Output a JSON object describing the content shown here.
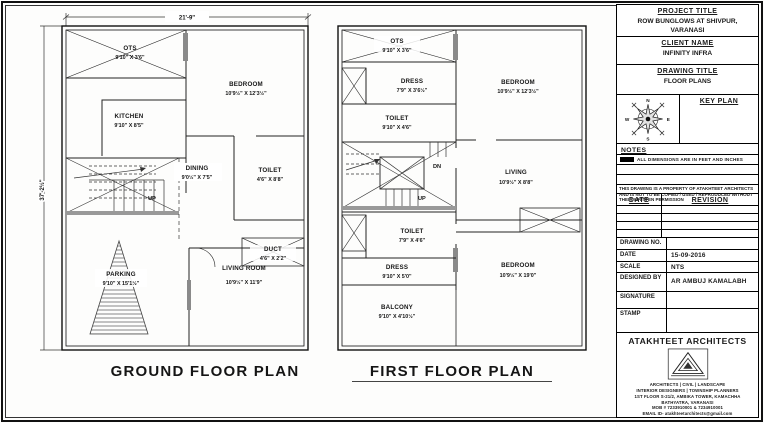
{
  "ground_floor": {
    "title": "GROUND FLOOR PLAN",
    "dim_width": "21'-9\"",
    "dim_height": "37'-2½\"",
    "stair_up": "UP",
    "rooms": {
      "ots": {
        "name": "OTS",
        "size": "9'10\" X 3'6\""
      },
      "kitchen": {
        "name": "KITCHEN",
        "size": "9'10\" X 8'5\""
      },
      "bedroom": {
        "name": "BEDROOM",
        "size": "10'9½\" X 12'3½\""
      },
      "dining": {
        "name": "DINING",
        "size": "9'0½\" X 7'5\""
      },
      "toilet": {
        "name": "TOILET",
        "size": "4'6\" X 8'8\""
      },
      "duct": {
        "name": "DUCT",
        "size": "4'6\" X 2'2\""
      },
      "parking": {
        "name": "PARKING",
        "size": "9'10\" X 15'1½\""
      },
      "living": {
        "name": "LIVING ROOM",
        "size": "10'9½\" X 11'9\""
      }
    }
  },
  "first_floor": {
    "title": "FIRST FLOOR PLAN",
    "stair_up": "UP",
    "stair_dn": "DN",
    "rooms": {
      "ots": {
        "name": "OTS",
        "size": "9'10\" X 3'6\""
      },
      "dress1": {
        "name": "DRESS",
        "size": "7'9\" X 3'6½\""
      },
      "bedroom1": {
        "name": "BEDROOM",
        "size": "10'9½\" X 12'3½\""
      },
      "toilet1": {
        "name": "TOILET",
        "size": "9'10\" X 4'6\""
      },
      "living": {
        "name": "LIVING",
        "size": "10'9½\" X 8'8\""
      },
      "toilet2": {
        "name": "TOILET",
        "size": "7'9\" X 4'6\""
      },
      "dress2": {
        "name": "DRESS",
        "size": "9'10\" X 5'0\""
      },
      "bedroom2": {
        "name": "BEDROOM",
        "size": "10'9½\" X 19'0\""
      },
      "balcony": {
        "name": "BALCONY",
        "size": "9'10\" X 4'10½\""
      }
    }
  },
  "title_block": {
    "project": {
      "label": "PROJECT TITLE",
      "value": "ROW BUNGLOWS AT SHIVPUR, VARANASI"
    },
    "client": {
      "label": "CLIENT NAME",
      "value": "INFINITY INFRA"
    },
    "drawing": {
      "label": "DRAWING TITLE",
      "value": "FLOOR PLANS"
    },
    "key_plan": {
      "label": "KEY PLAN",
      "compass": {
        "n": "N",
        "e": "E",
        "s": "S",
        "w": "W"
      }
    },
    "notes": {
      "label": "NOTES",
      "note1": "ALL DIMENSIONS ARE IN FEET AND INCHES"
    },
    "disclaimer": "THIS DRAWING IS A PROPERTY OF ATAKHTEET ARCHITECTS AND IS NOT TO BE COPIED / USED / REPRODUCED WITHOUT THEIR WRITTEN PERMISSION",
    "revision_table": {
      "date_label": "DATE",
      "revision_label": "REVISION"
    },
    "fields": {
      "drawing_no": {
        "label": "DRAWING NO.",
        "value": ""
      },
      "date": {
        "label": "DATE",
        "value": "15-09-2016"
      },
      "scale": {
        "label": "SCALE",
        "value": "NTS"
      },
      "designed_by": {
        "label": "DESIGNED BY",
        "value": "AR AMBUJ KAMALABH"
      },
      "signature": {
        "label": "SIGNATURE",
        "value": ""
      },
      "stamp": {
        "label": "STAMP",
        "value": ""
      }
    },
    "firm": {
      "name": "ATAKHTEET ARCHITECTS",
      "lines": [
        "ARCHITECTS | CIVIL | LANDSCAPE",
        "INTERIOR DESIGNERS | TOWNSHIP PLANNERS",
        "1ST FLOOR S-21/2, AMBIKA TOWER, KAMACHHA",
        "BATHYATRA, VARANASI",
        "MOB # 7233910001 & 7234910001",
        "EMAIL ID- atakhteetarchitects@gmail.com"
      ]
    }
  }
}
